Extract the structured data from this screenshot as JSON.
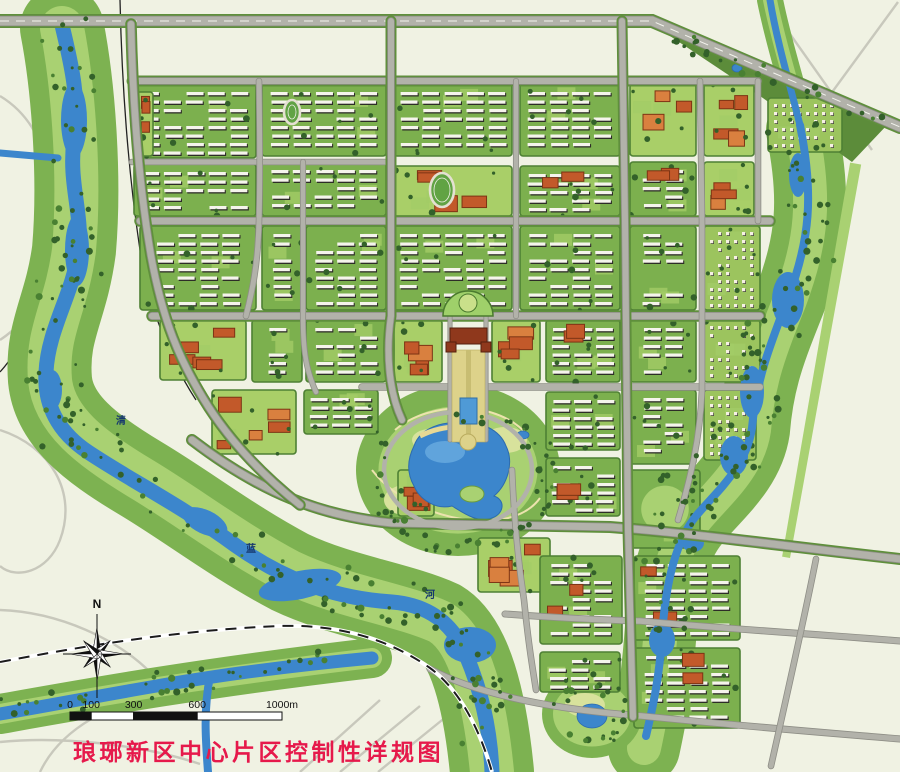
{
  "map": {
    "title": {
      "text": "琅琊新区中心片区控制性详规图",
      "color": "#e6194b"
    },
    "compass": {
      "label": "N"
    },
    "scale_bar": {
      "unit": "m",
      "ticks": [
        {
          "label": "0",
          "m": 0
        },
        {
          "label": "100",
          "m": 100
        },
        {
          "label": "300",
          "m": 300
        },
        {
          "label": "600",
          "m": 600
        },
        {
          "label": "1000m",
          "m": 1000
        }
      ]
    },
    "river_labels": [
      {
        "text": "清",
        "x": 121,
        "y": 424
      },
      {
        "text": "蓝",
        "x": 251,
        "y": 552
      },
      {
        "text": "河",
        "x": 430,
        "y": 598
      }
    ],
    "palette": {
      "bg": "#f0f2e3",
      "creamRoad": "#c8c8bc",
      "water": "#3c86cc",
      "waterDeep": "#2d6bae",
      "corridor": "#7db251",
      "corridorLight": "#a9d172",
      "lawn": "#d8e29c",
      "treeDark": "#33612a",
      "treeMid": "#498032",
      "blockGreen": "#7cb04e",
      "blockEdge": "#4e8034",
      "slabWhite": "#f5f4ec",
      "slabShadow": "#2d2d27",
      "orange": "#c2592a",
      "orangeDark": "#7c3414",
      "orangeLight": "#d9803f",
      "road": "#b2b2aa",
      "roadCase": "#8e8e86",
      "rail": "#1c1c1c",
      "titleRed": "#e6194b",
      "labelBlue": "#16386e",
      "trackGreen": "#61a344",
      "trackLine": "#e4e0d2",
      "axisSand": "#ddd28a",
      "civicRed": "#8f381c"
    },
    "blocks": [
      {
        "x": 134,
        "y": 84,
        "w": 122,
        "h": 74,
        "k": "slab"
      },
      {
        "x": 137,
        "y": 92,
        "w": 16,
        "h": 64,
        "k": "orange"
      },
      {
        "x": 134,
        "y": 164,
        "w": 122,
        "h": 52,
        "k": "slab"
      },
      {
        "x": 140,
        "y": 226,
        "w": 116,
        "h": 84,
        "k": "slab"
      },
      {
        "x": 262,
        "y": 84,
        "w": 124,
        "h": 72,
        "k": "slab"
      },
      {
        "x": 262,
        "y": 162,
        "w": 124,
        "h": 54,
        "k": "slab"
      },
      {
        "x": 262,
        "y": 226,
        "w": 40,
        "h": 84,
        "k": "slab"
      },
      {
        "x": 306,
        "y": 226,
        "w": 80,
        "h": 84,
        "k": "slab"
      },
      {
        "x": 160,
        "y": 320,
        "w": 86,
        "h": 60,
        "k": "orange"
      },
      {
        "x": 252,
        "y": 320,
        "w": 50,
        "h": 62,
        "k": "slab"
      },
      {
        "x": 306,
        "y": 320,
        "w": 80,
        "h": 62,
        "k": "slab"
      },
      {
        "x": 212,
        "y": 390,
        "w": 84,
        "h": 64,
        "k": "orange"
      },
      {
        "x": 304,
        "y": 390,
        "w": 74,
        "h": 44,
        "k": "slab"
      },
      {
        "x": 394,
        "y": 84,
        "w": 118,
        "h": 72,
        "k": "slab"
      },
      {
        "x": 394,
        "y": 166,
        "w": 118,
        "h": 50,
        "k": "campus"
      },
      {
        "x": 520,
        "y": 84,
        "w": 100,
        "h": 72,
        "k": "slab"
      },
      {
        "x": 520,
        "y": 166,
        "w": 100,
        "h": 50,
        "k": "mixed"
      },
      {
        "x": 394,
        "y": 226,
        "w": 118,
        "h": 84,
        "k": "slab"
      },
      {
        "x": 520,
        "y": 226,
        "w": 100,
        "h": 84,
        "k": "slab"
      },
      {
        "x": 394,
        "y": 320,
        "w": 48,
        "h": 62,
        "k": "orange"
      },
      {
        "x": 492,
        "y": 320,
        "w": 48,
        "h": 62,
        "k": "orange"
      },
      {
        "x": 546,
        "y": 320,
        "w": 74,
        "h": 62,
        "k": "mixed"
      },
      {
        "x": 546,
        "y": 392,
        "w": 74,
        "h": 58,
        "k": "slab"
      },
      {
        "x": 546,
        "y": 458,
        "w": 74,
        "h": 58,
        "k": "mixed"
      },
      {
        "x": 630,
        "y": 84,
        "w": 66,
        "h": 72,
        "k": "orange"
      },
      {
        "x": 630,
        "y": 162,
        "w": 66,
        "h": 54,
        "k": "mixed"
      },
      {
        "x": 630,
        "y": 226,
        "w": 66,
        "h": 84,
        "k": "slab"
      },
      {
        "x": 630,
        "y": 320,
        "w": 66,
        "h": 62,
        "k": "slab"
      },
      {
        "x": 630,
        "y": 390,
        "w": 66,
        "h": 74,
        "k": "slab"
      },
      {
        "x": 704,
        "y": 84,
        "w": 50,
        "h": 72,
        "k": "orange"
      },
      {
        "x": 704,
        "y": 162,
        "w": 50,
        "h": 54,
        "k": "orange"
      },
      {
        "x": 768,
        "y": 98,
        "w": 74,
        "h": 54,
        "k": "villa"
      },
      {
        "x": 704,
        "y": 226,
        "w": 56,
        "h": 84,
        "k": "villa"
      },
      {
        "x": 704,
        "y": 320,
        "w": 56,
        "h": 62,
        "k": "villa"
      },
      {
        "x": 704,
        "y": 390,
        "w": 52,
        "h": 70,
        "k": "villa"
      },
      {
        "x": 630,
        "y": 470,
        "w": 70,
        "h": 78,
        "k": "park"
      },
      {
        "x": 398,
        "y": 470,
        "w": 36,
        "h": 46,
        "k": "orange"
      },
      {
        "x": 478,
        "y": 538,
        "w": 72,
        "h": 54,
        "k": "orange"
      },
      {
        "x": 540,
        "y": 556,
        "w": 82,
        "h": 88,
        "k": "mixed"
      },
      {
        "x": 540,
        "y": 652,
        "w": 80,
        "h": 40,
        "k": "slab"
      },
      {
        "x": 634,
        "y": 556,
        "w": 106,
        "h": 84,
        "k": "mixed"
      },
      {
        "x": 634,
        "y": 648,
        "w": 106,
        "h": 80,
        "k": "mixed"
      }
    ],
    "features": {
      "tracks": [
        {
          "cx": 442,
          "cy": 190,
          "rx": 12,
          "ry": 17
        },
        {
          "cx": 292,
          "cy": 112,
          "rx": 8,
          "ry": 12
        }
      ],
      "ponds": [
        {
          "cx": 592,
          "cy": 716,
          "rx": 15,
          "ry": 12
        },
        {
          "cx": 523,
          "cy": 435,
          "rx": 6,
          "ry": 4
        },
        {
          "cx": 737,
          "cy": 68,
          "rx": 5,
          "ry": 4
        }
      ]
    }
  }
}
